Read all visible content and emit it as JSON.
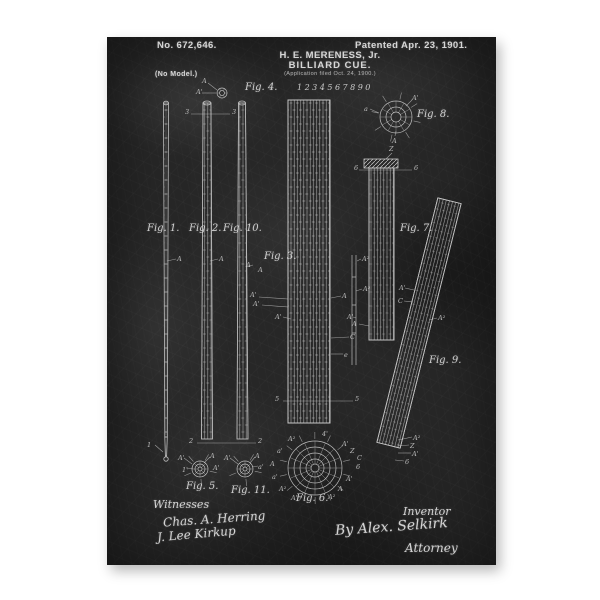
{
  "page": {
    "background_color": "#ffffff",
    "board_color": "#272727",
    "chalk_color": "#dcdcdc"
  },
  "header": {
    "patent_number": "No. 672,646.",
    "patent_date": "Patented Apr. 23, 1901.",
    "inventor_name": "H. E. MERENESS, Jr.",
    "title": "BILLIARD CUE.",
    "application_note": "(Application filed Oct. 24, 1900.)",
    "model_note": "(No Model.)"
  },
  "segment_numbers": "1234567890",
  "figure_labels": [
    {
      "text": "Fig. 1.",
      "x": 40,
      "y": 186
    },
    {
      "text": "Fig. 2.",
      "x": 82,
      "y": 186
    },
    {
      "text": "Fig. 10.",
      "x": 116,
      "y": 186
    },
    {
      "text": "Fig. 3.",
      "x": 157,
      "y": 214
    },
    {
      "text": "Fig. 4.",
      "x": 138,
      "y": 45
    },
    {
      "text": "Fig. 5.",
      "x": 79,
      "y": 444
    },
    {
      "text": "Fig. 6.",
      "x": 189,
      "y": 456
    },
    {
      "text": "Fig. 7.",
      "x": 293,
      "y": 186
    },
    {
      "text": "Fig. 8.",
      "x": 310,
      "y": 72
    },
    {
      "text": "Fig. 9.",
      "x": 322,
      "y": 318
    },
    {
      "text": "Fig. 11.",
      "x": 124,
      "y": 448
    }
  ],
  "annotations": [
    {
      "t": "A",
      "x": 95,
      "y": 40
    },
    {
      "t": "A'",
      "x": 89,
      "y": 51
    },
    {
      "t": "3",
      "x": 78,
      "y": 71
    },
    {
      "t": "3",
      "x": 125,
      "y": 71
    },
    {
      "t": "A",
      "x": 70,
      "y": 218
    },
    {
      "t": "A",
      "x": 112,
      "y": 218
    },
    {
      "t": "A",
      "x": 139,
      "y": 224
    },
    {
      "t": "A",
      "x": 151,
      "y": 229
    },
    {
      "t": "A'",
      "x": 143,
      "y": 254
    },
    {
      "t": "A'",
      "x": 146,
      "y": 263
    },
    {
      "t": "A'",
      "x": 168,
      "y": 276
    },
    {
      "t": "A²",
      "x": 255,
      "y": 218
    },
    {
      "t": "A²",
      "x": 256,
      "y": 248
    },
    {
      "t": "A",
      "x": 235,
      "y": 255
    },
    {
      "t": "A'",
      "x": 240,
      "y": 276
    },
    {
      "t": "C",
      "x": 243,
      "y": 296
    },
    {
      "t": "e",
      "x": 237,
      "y": 314
    },
    {
      "t": "5",
      "x": 168,
      "y": 358
    },
    {
      "t": "5",
      "x": 248,
      "y": 358
    },
    {
      "t": "1",
      "x": 40,
      "y": 404
    },
    {
      "t": "2",
      "x": 82,
      "y": 400
    },
    {
      "t": "2",
      "x": 151,
      "y": 400
    },
    {
      "t": "Z",
      "x": 282,
      "y": 108
    },
    {
      "t": "6",
      "x": 247,
      "y": 127
    },
    {
      "t": "6",
      "x": 307,
      "y": 127
    },
    {
      "t": "A",
      "x": 245,
      "y": 283
    },
    {
      "t": "a",
      "x": 257,
      "y": 68
    },
    {
      "t": "A'",
      "x": 305,
      "y": 57
    },
    {
      "t": "A",
      "x": 285,
      "y": 100
    },
    {
      "t": "A'",
      "x": 292,
      "y": 247
    },
    {
      "t": "C",
      "x": 291,
      "y": 260
    },
    {
      "t": "A²",
      "x": 331,
      "y": 277
    },
    {
      "t": "A²",
      "x": 306,
      "y": 397
    },
    {
      "t": "Z",
      "x": 303,
      "y": 405
    },
    {
      "t": "A'",
      "x": 305,
      "y": 413
    },
    {
      "t": "6",
      "x": 298,
      "y": 421
    },
    {
      "t": "A'",
      "x": 71,
      "y": 417
    },
    {
      "t": "A",
      "x": 103,
      "y": 415
    },
    {
      "t": "1'",
      "x": 75,
      "y": 429
    },
    {
      "t": "A'",
      "x": 106,
      "y": 427
    },
    {
      "t": "A'",
      "x": 117,
      "y": 417
    },
    {
      "t": "A",
      "x": 148,
      "y": 415
    },
    {
      "t": "a'",
      "x": 151,
      "y": 426
    },
    {
      "t": "A²",
      "x": 181,
      "y": 398
    },
    {
      "t": "a'",
      "x": 170,
      "y": 410
    },
    {
      "t": "A",
      "x": 163,
      "y": 423
    },
    {
      "t": "a'",
      "x": 165,
      "y": 436
    },
    {
      "t": "A²",
      "x": 172,
      "y": 448
    },
    {
      "t": "A'",
      "x": 184,
      "y": 457
    },
    {
      "t": "4'",
      "x": 215,
      "y": 393
    },
    {
      "t": "A'",
      "x": 235,
      "y": 403
    },
    {
      "t": "Z",
      "x": 243,
      "y": 410
    },
    {
      "t": "C",
      "x": 250,
      "y": 417
    },
    {
      "t": "6",
      "x": 249,
      "y": 426
    },
    {
      "t": "A'",
      "x": 239,
      "y": 438
    },
    {
      "t": "A",
      "x": 231,
      "y": 448
    },
    {
      "t": "A²",
      "x": 221,
      "y": 456
    }
  ],
  "footer": {
    "witnesses_label": "Witnesses",
    "witness_signature_1": "Chas. A. Herring",
    "witness_signature_2": "J. Lee Kirkup",
    "inventor_label": "Inventor",
    "attorney_signature": "By Alex. Selkirk",
    "attorney_label": "Attorney"
  }
}
